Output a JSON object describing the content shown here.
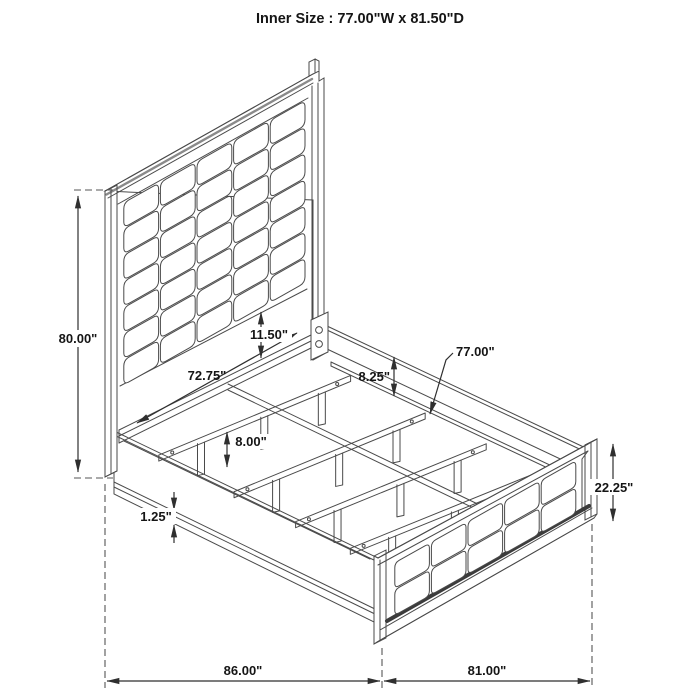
{
  "title": "Inner Size : 77.00\"W x 81.50\"D",
  "dimensions": {
    "headboard_height": "80.00\"",
    "headboard_panel_width": "72.75\"",
    "headboard_gap": "11.50\"",
    "side_rail_drop": "8.25\"",
    "slat_width": "77.00\"",
    "slat_leg_height": "8.00\"",
    "rail_trim_thickness": "1.25\"",
    "footboard_height": "22.25\"",
    "overall_length": "86.00\"",
    "overall_width": "81.00\""
  },
  "colors": {
    "line": "#4a4a4a",
    "dash": "#555555",
    "dimension": "#2f2f2f",
    "text": "#151515",
    "background": "#ffffff"
  }
}
